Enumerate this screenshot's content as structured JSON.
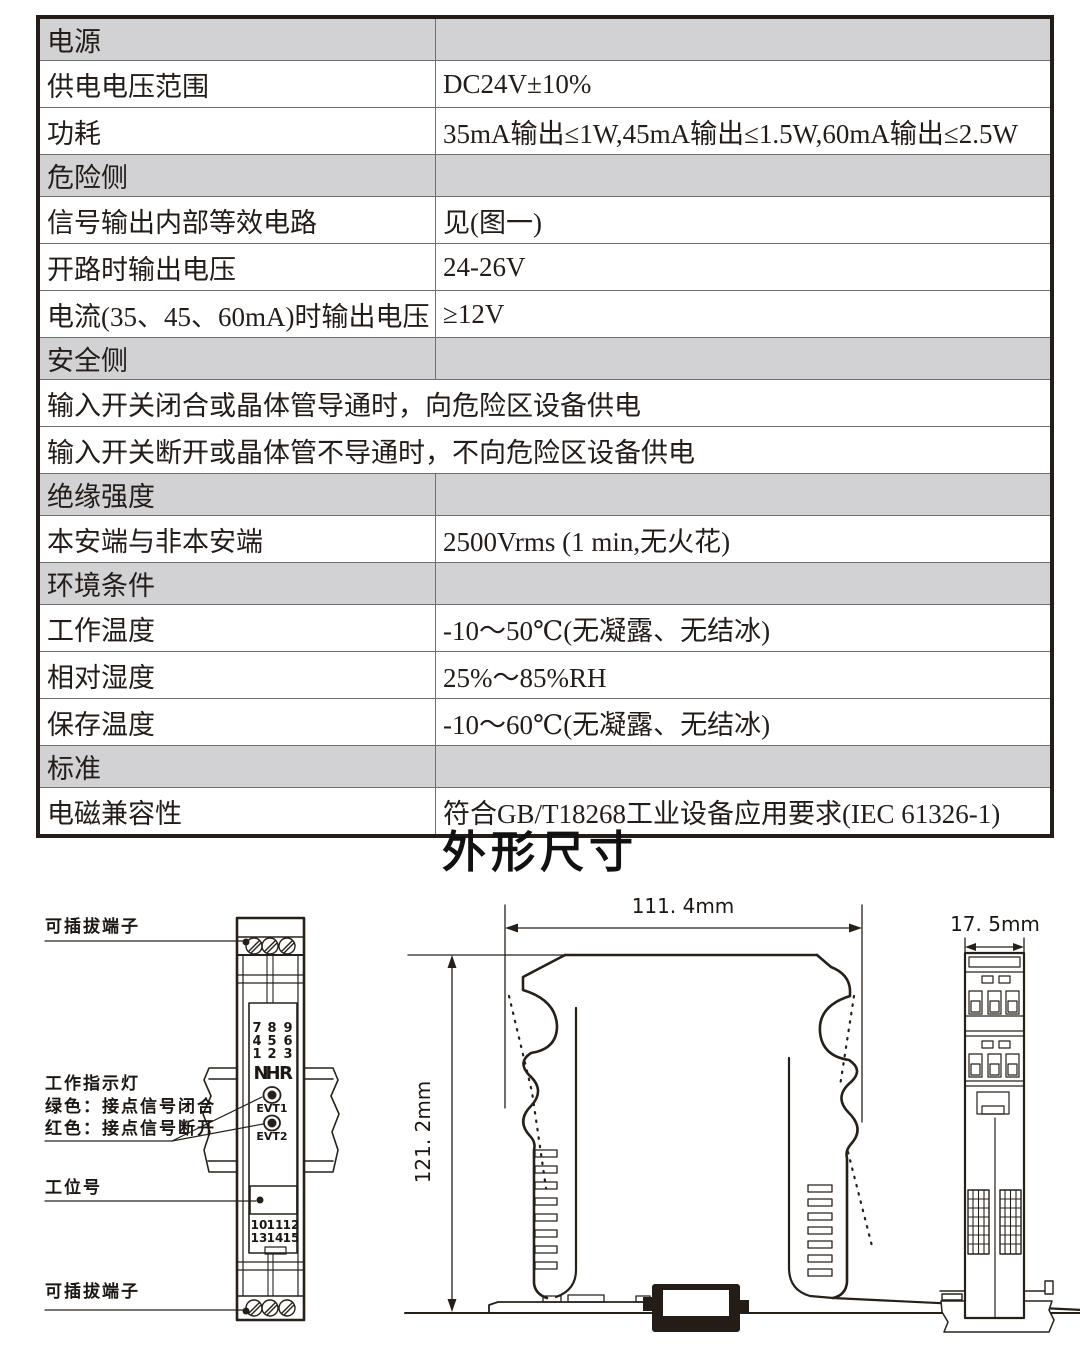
{
  "title": "外形尺寸",
  "colors": {
    "line": "#272019",
    "table_header_bg": "#d2d2d4",
    "accent_red": "#c8251d",
    "text": "#231c18"
  },
  "spec_table": {
    "rows": [
      {
        "type": "section",
        "label": "电源",
        "value": ""
      },
      {
        "type": "data",
        "label": "供电电压范围",
        "value": "DC24V±10%"
      },
      {
        "type": "data",
        "label": "功耗",
        "value": "35mA输出≤1W,45mA输出≤1.5W,60mA输出≤2.5W"
      },
      {
        "type": "section",
        "label": "危险侧",
        "value": ""
      },
      {
        "type": "data",
        "label": "信号输出内部等效电路",
        "value": "见(图一)"
      },
      {
        "type": "data",
        "label": "开路时输出电压",
        "value": "24-26V"
      },
      {
        "type": "data",
        "label": "电流(35、45、60mA)时输出电压",
        "value": "≥12V"
      },
      {
        "type": "section",
        "label": "安全侧",
        "value": ""
      },
      {
        "type": "full",
        "label": "输入开关闭合或晶体管导通时，向危险区设备供电"
      },
      {
        "type": "full",
        "label": "输入开关断开或晶体管不导通时，不向危险区设备供电"
      },
      {
        "type": "section",
        "label": "绝缘强度",
        "value": ""
      },
      {
        "type": "data",
        "label": "本安端与非本安端",
        "value": "2500Vrms (1 min,无火花)"
      },
      {
        "type": "section",
        "label": "环境条件",
        "value": ""
      },
      {
        "type": "data",
        "label": "工作温度",
        "value": "-10～50℃(无凝露、无结冰)"
      },
      {
        "type": "data",
        "label": "相对湿度",
        "value": "25%～85%RH"
      },
      {
        "type": "data",
        "label": "保存温度",
        "value": "-10～60℃(无凝露、无结冰)"
      },
      {
        "type": "section",
        "label": "标准",
        "value": ""
      },
      {
        "type": "data",
        "label": "电磁兼容性",
        "value": "符合GB/T18268工业设备应用要求(IEC 61326-1)"
      }
    ]
  },
  "drawings": {
    "front_view": {
      "labels": {
        "pluggable_top": "可插拔端子",
        "indicator_title": "工作指示灯",
        "indicator_green": "绿色：接点信号闭合",
        "indicator_red": "红色：接点信号断开",
        "tag": "工位号",
        "pluggable_bottom": "可插拔端子"
      },
      "logo": {
        "l1": "N",
        "l2": "H",
        "l3": "R"
      },
      "terminal_digits_top": [
        [
          "7",
          "8",
          "9"
        ],
        [
          "4",
          "5",
          "6"
        ],
        [
          "1",
          "2",
          "3"
        ]
      ],
      "terminal_digits_bottom": [
        [
          "10",
          "11",
          "12"
        ],
        [
          "13",
          "14",
          "15"
        ]
      ],
      "led1": "EVT1",
      "led2": "EVT2"
    },
    "side_view": {
      "width_dim": "111. 4mm",
      "height_dim": "121. 2mm"
    },
    "end_view": {
      "depth_dim": "17. 5mm"
    }
  }
}
